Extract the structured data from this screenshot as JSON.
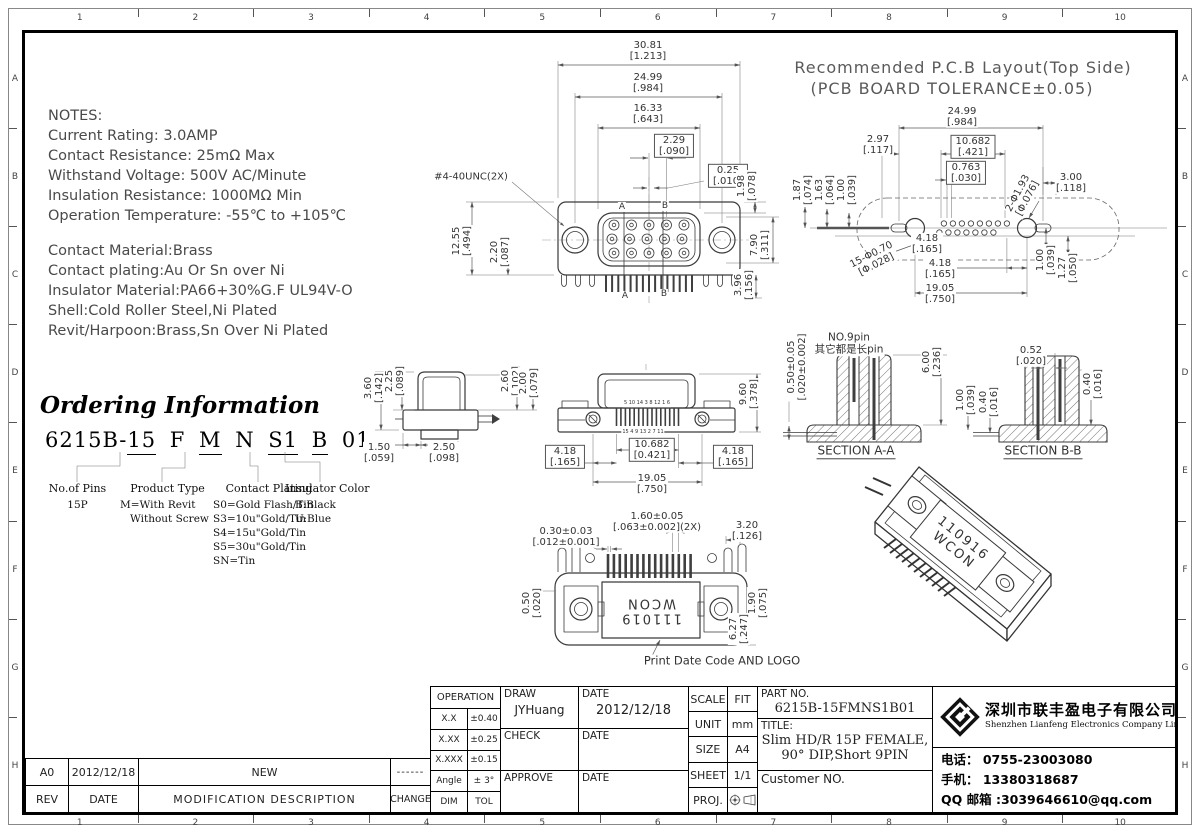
{
  "ruler": {
    "cols": [
      "1",
      "2",
      "3",
      "4",
      "5",
      "6",
      "7",
      "8",
      "9",
      "10"
    ],
    "rows": [
      "A",
      "B",
      "C",
      "D",
      "E",
      "F",
      "G",
      "H"
    ]
  },
  "notes": {
    "block1": [
      "NOTES:",
      "Current Rating: 3.0AMP",
      "Contact Resistance: 25mΩ Max",
      "Withstand Voltage: 500V AC/Minute",
      "Insulation Resistance: 1000MΩ Min",
      "Operation Temperature: -55℃ to +105℃"
    ],
    "block2": [
      "Contact Material:Brass",
      "Contact plating:Au Or Sn over Ni",
      "Insulator Material:PA66+30%G.F UL94V-O",
      "Shell:Cold Roller Steel,Ni Plated",
      "Revit/Harpoon:Brass,Sn Over Ni Plated"
    ]
  },
  "ordering": {
    "title": "Ordering Information",
    "code": [
      {
        "t": "6215B-",
        "u": 0
      },
      {
        "t": "15",
        "u": 1
      },
      {
        "t": " F ",
        "u": 0
      },
      {
        "t": "M",
        "u": 1
      },
      {
        "t": " N ",
        "u": 0
      },
      {
        "t": "S1",
        "u": 1
      },
      {
        "t": " ",
        "u": 0
      },
      {
        "t": "B",
        "u": 1
      },
      {
        "t": " 01",
        "u": 0
      }
    ],
    "groups": [
      {
        "label": "No.of Pins",
        "lines": [
          "15P"
        ]
      },
      {
        "label": "Product Type",
        "lines": [
          "M=With Revit",
          "   Without Screw"
        ]
      },
      {
        "label": "Contact Plating",
        "lines": [
          "S0=Gold Flash/Tin",
          "S3=10u\"Gold/Tin",
          "S4=15u\"Gold/Tin",
          "S5=30u\"Gold/Tin",
          "SN=Tin"
        ]
      },
      {
        "label": "Insulator Color",
        "lines": [
          "B:Black",
          "U:Blue"
        ]
      }
    ]
  },
  "annotations": [
    {
      "n": "dim-overall-width",
      "x": 648,
      "y": 51,
      "l": [
        "30.81",
        "[1.213]"
      ]
    },
    {
      "n": "dim-hole-span",
      "x": 648,
      "y": 83,
      "l": [
        "24.99",
        "[.984]"
      ]
    },
    {
      "n": "dim-shroud-width",
      "x": 648,
      "y": 114,
      "l": [
        "16.33",
        "[.643]"
      ]
    },
    {
      "n": "dim-pin-pitch",
      "x": 674,
      "y": 146,
      "l": [
        "2.29",
        "[.090]"
      ],
      "box": 1
    },
    {
      "n": "dim-offset",
      "x": 728,
      "y": 176,
      "l": [
        "0.25",
        "[.010]"
      ],
      "box": 1
    },
    {
      "n": "thread-callout",
      "x": 471,
      "y": 177,
      "l": [
        "#4-40UNC(2X)"
      ]
    },
    {
      "n": "dim",
      "x": 747,
      "y": 186,
      "r": -90,
      "l": [
        "1.98",
        "[.078]"
      ]
    },
    {
      "n": "dim-flange-height",
      "x": 462,
      "y": 241,
      "r": -90,
      "l": [
        "12.55",
        "[.494]"
      ]
    },
    {
      "n": "dim",
      "x": 500,
      "y": 252,
      "r": -90,
      "l": [
        "2.20",
        "[.087]"
      ]
    },
    {
      "n": "dim",
      "x": 760,
      "y": 245,
      "r": -90,
      "l": [
        "7.90",
        "[.311]"
      ]
    },
    {
      "n": "dim",
      "x": 744,
      "y": 285,
      "r": -90,
      "l": [
        "3.96",
        "[.156]"
      ]
    },
    {
      "n": "section-mark-a",
      "x": 622,
      "y": 207,
      "l": [
        "A"
      ],
      "size": 9
    },
    {
      "n": "section-mark-b",
      "x": 665,
      "y": 206,
      "l": [
        "B"
      ],
      "size": 9
    },
    {
      "n": "section-mark-a",
      "x": 625,
      "y": 296,
      "l": [
        "A"
      ],
      "size": 9
    },
    {
      "n": "section-mark-b",
      "x": 664,
      "y": 294,
      "l": [
        "B"
      ],
      "size": 9
    },
    {
      "n": "pcb-title-line1",
      "x": 963,
      "y": 68,
      "l": [
        "Recommended P.C.B Layout(Top Side)"
      ],
      "size": 16,
      "color": "#5a5a5a",
      "ls": 1
    },
    {
      "n": "pcb-title-line2",
      "x": 952,
      "y": 89,
      "l": [
        "(PCB BOARD TOLERANCE±0.05)"
      ],
      "size": 16,
      "color": "#5a5a5a",
      "ls": 1
    },
    {
      "n": "dim",
      "x": 962,
      "y": 117,
      "l": [
        "24.99",
        "[.984]"
      ]
    },
    {
      "n": "dim",
      "x": 878,
      "y": 145,
      "l": [
        "2.97",
        "[.117]"
      ]
    },
    {
      "n": "dim",
      "x": 973,
      "y": 147,
      "l": [
        "10.682",
        "[.421]"
      ],
      "box": 1
    },
    {
      "n": "dim",
      "x": 966,
      "y": 173,
      "l": [
        "0.763",
        "[.030]"
      ],
      "box": 1
    },
    {
      "n": "dim",
      "x": 803,
      "y": 190,
      "r": -90,
      "l": [
        "1.87",
        "[.074]"
      ]
    },
    {
      "n": "dim",
      "x": 825,
      "y": 190,
      "r": -90,
      "l": [
        "1.63",
        "[.064]"
      ]
    },
    {
      "n": "dim",
      "x": 847,
      "y": 190,
      "r": -90,
      "l": [
        "1.00",
        "[.039]"
      ]
    },
    {
      "n": "dim-hole-callout",
      "x": 1023,
      "y": 196,
      "r": -62,
      "l": [
        "2-Φ1.93",
        "[Φ.076]"
      ]
    },
    {
      "n": "dim",
      "x": 1071,
      "y": 183,
      "l": [
        "3.00",
        "[.118]"
      ]
    },
    {
      "n": "dim-hole-callout",
      "x": 874,
      "y": 260,
      "r": -27,
      "l": [
        "15-Φ0.70",
        "[Φ.028]"
      ]
    },
    {
      "n": "dim",
      "x": 927,
      "y": 244,
      "l": [
        "4.18",
        "[.165]"
      ]
    },
    {
      "n": "dim",
      "x": 940,
      "y": 269,
      "l": [
        "4.18",
        "[.165]"
      ]
    },
    {
      "n": "dim",
      "x": 940,
      "y": 294,
      "l": [
        "19.05",
        "[.750]"
      ]
    },
    {
      "n": "dim",
      "x": 1046,
      "y": 260,
      "r": -90,
      "l": [
        "1.00",
        "[.039]"
      ]
    },
    {
      "n": "dim",
      "x": 1068,
      "y": 268,
      "r": -90,
      "l": [
        "1.27",
        "[.050]"
      ]
    },
    {
      "n": "dim",
      "x": 374,
      "y": 388,
      "r": -90,
      "l": [
        "3.60",
        "[.142]"
      ]
    },
    {
      "n": "dim",
      "x": 395,
      "y": 381,
      "r": -90,
      "l": [
        "2.25",
        "[.089]"
      ]
    },
    {
      "n": "dim",
      "x": 511,
      "y": 381,
      "r": -90,
      "l": [
        "2.60",
        "[.102]"
      ]
    },
    {
      "n": "dim",
      "x": 529,
      "y": 383,
      "r": -90,
      "l": [
        "2.00",
        "[.079]"
      ]
    },
    {
      "n": "dim",
      "x": 379,
      "y": 453,
      "l": [
        "1.50",
        "[.059]"
      ]
    },
    {
      "n": "dim",
      "x": 444,
      "y": 453,
      "l": [
        "2.50",
        "[.098]"
      ]
    },
    {
      "n": "dim",
      "x": 749,
      "y": 394,
      "r": -90,
      "l": [
        "9.60",
        "[.378]"
      ]
    },
    {
      "n": "dim",
      "x": 565,
      "y": 457,
      "l": [
        "4.18",
        "[.165]"
      ],
      "box": 1
    },
    {
      "n": "dim",
      "x": 652,
      "y": 450,
      "l": [
        "10.682",
        "[0.421]"
      ],
      "box": 1
    },
    {
      "n": "dim",
      "x": 733,
      "y": 457,
      "l": [
        "4.18",
        "[.165]"
      ],
      "box": 1
    },
    {
      "n": "dim",
      "x": 652,
      "y": 484,
      "l": [
        "19.05",
        "[.750]"
      ]
    },
    {
      "n": "pin-numbers-top",
      "x": 647,
      "y": 404,
      "l": [
        "5 10 14 3 8 12 1 6"
      ],
      "size": 5
    },
    {
      "n": "pin-numbers-bottom",
      "x": 643,
      "y": 433,
      "l": [
        "15 4 9 13 2 7 11"
      ],
      "size": 5
    },
    {
      "n": "dim",
      "x": 797,
      "y": 367,
      "r": -90,
      "l": [
        "0.50±0.05",
        "[.020±0.002]"
      ]
    },
    {
      "n": "pin9-note",
      "x": 849,
      "y": 344,
      "l": [
        "NO.9pin",
        "其它都是长pin"
      ],
      "size": 10.5
    },
    {
      "n": "dim",
      "x": 932,
      "y": 362,
      "r": -90,
      "l": [
        "6.00",
        "[.236]"
      ]
    },
    {
      "n": "section-aa-label",
      "x": 856,
      "y": 452,
      "l": [
        "SECTION A-A"
      ],
      "size": 12,
      "u": 1
    },
    {
      "n": "dim",
      "x": 966,
      "y": 400,
      "r": -90,
      "l": [
        "1.00",
        "[.039]"
      ]
    },
    {
      "n": "dim",
      "x": 989,
      "y": 402,
      "r": -90,
      "l": [
        "0.40",
        "[.016]"
      ]
    },
    {
      "n": "dim",
      "x": 1031,
      "y": 356,
      "l": [
        "0.52",
        "[.020]"
      ]
    },
    {
      "n": "dim",
      "x": 1093,
      "y": 384,
      "r": -90,
      "l": [
        "0.40",
        "[.016]"
      ]
    },
    {
      "n": "section-bb-label",
      "x": 1043,
      "y": 452,
      "l": [
        "SECTION B-B"
      ],
      "size": 12,
      "u": 1
    },
    {
      "n": "dim",
      "x": 566,
      "y": 537,
      "l": [
        "0.30±0.03",
        "[.012±0.001]"
      ]
    },
    {
      "n": "dim",
      "x": 657,
      "y": 522,
      "l": [
        "1.60±0.05",
        "[.063±0.002](2X)"
      ]
    },
    {
      "n": "dim",
      "x": 747,
      "y": 531,
      "l": [
        "3.20",
        "[.126]"
      ]
    },
    {
      "n": "dim",
      "x": 532,
      "y": 603,
      "r": -90,
      "l": [
        "0.50",
        "[.020]"
      ]
    },
    {
      "n": "dim",
      "x": 758,
      "y": 603,
      "r": -90,
      "l": [
        "1.90",
        "[.075]"
      ]
    },
    {
      "n": "dim",
      "x": 739,
      "y": 629,
      "r": -90,
      "l": [
        "6.27",
        "[.247]"
      ]
    },
    {
      "n": "date-code-marking",
      "x": 651,
      "y": 610,
      "r": 180,
      "l": [
        "111019",
        "WCON"
      ],
      "size": 13,
      "ls": 2
    },
    {
      "n": "print-note",
      "x": 722,
      "y": 661,
      "l": [
        "Print Date Code AND LOGO"
      ],
      "size": 11.5
    },
    {
      "n": "iso-marking",
      "x": 958,
      "y": 545,
      "r": 39,
      "l": [
        "110916",
        "WCON"
      ],
      "size": 13,
      "ls": 2
    }
  ],
  "titleblock": {
    "tol": {
      "header": "OPERATION",
      "rows": [
        [
          "X.X",
          "±0.40"
        ],
        [
          "X.XX",
          "±0.25"
        ],
        [
          "X.XXX",
          "±0.15"
        ],
        [
          "Angle",
          "± 3°"
        ],
        [
          "DIM",
          "TOL"
        ]
      ]
    },
    "sign": {
      "draw_label": "DRAW",
      "draw_name": "JYHuang",
      "date_label": "DATE",
      "draw_date": "2012/12/18",
      "check_label": "CHECK",
      "approve_label": "APPROVE"
    },
    "info": {
      "scale_label": "SCALE",
      "scale": "FIT",
      "unit_label": "UNIT",
      "unit": "mm",
      "size_label": "SIZE",
      "size": "A4",
      "sheet_label": "SHEET",
      "sheet": "1/1",
      "proj_label": "PROJ."
    },
    "part": {
      "label": "PART NO.",
      "value": "6215B-15FMNS1B01",
      "title_label": "TITLE:",
      "title1": "Slim HD/R 15P FEMALE,",
      "title2": "90° DIP,Short 9PIN",
      "customer": "Customer NO."
    },
    "company": {
      "cn": "深圳市联丰盈电子有限公司",
      "en": "Shenzhen Lianfeng Electronics Company Limited",
      "tel": "电话： 0755-23003080",
      "mobile": "手机： 13380318687",
      "qq": "QQ 邮箱 :3039646610@qq.com"
    },
    "rev": {
      "row": [
        "A0",
        "2012/12/18",
        "NEW",
        "------"
      ],
      "header": [
        "REV",
        "DATE",
        "MODIFICATION  DESCRIPTION",
        "CHANGE"
      ]
    }
  }
}
